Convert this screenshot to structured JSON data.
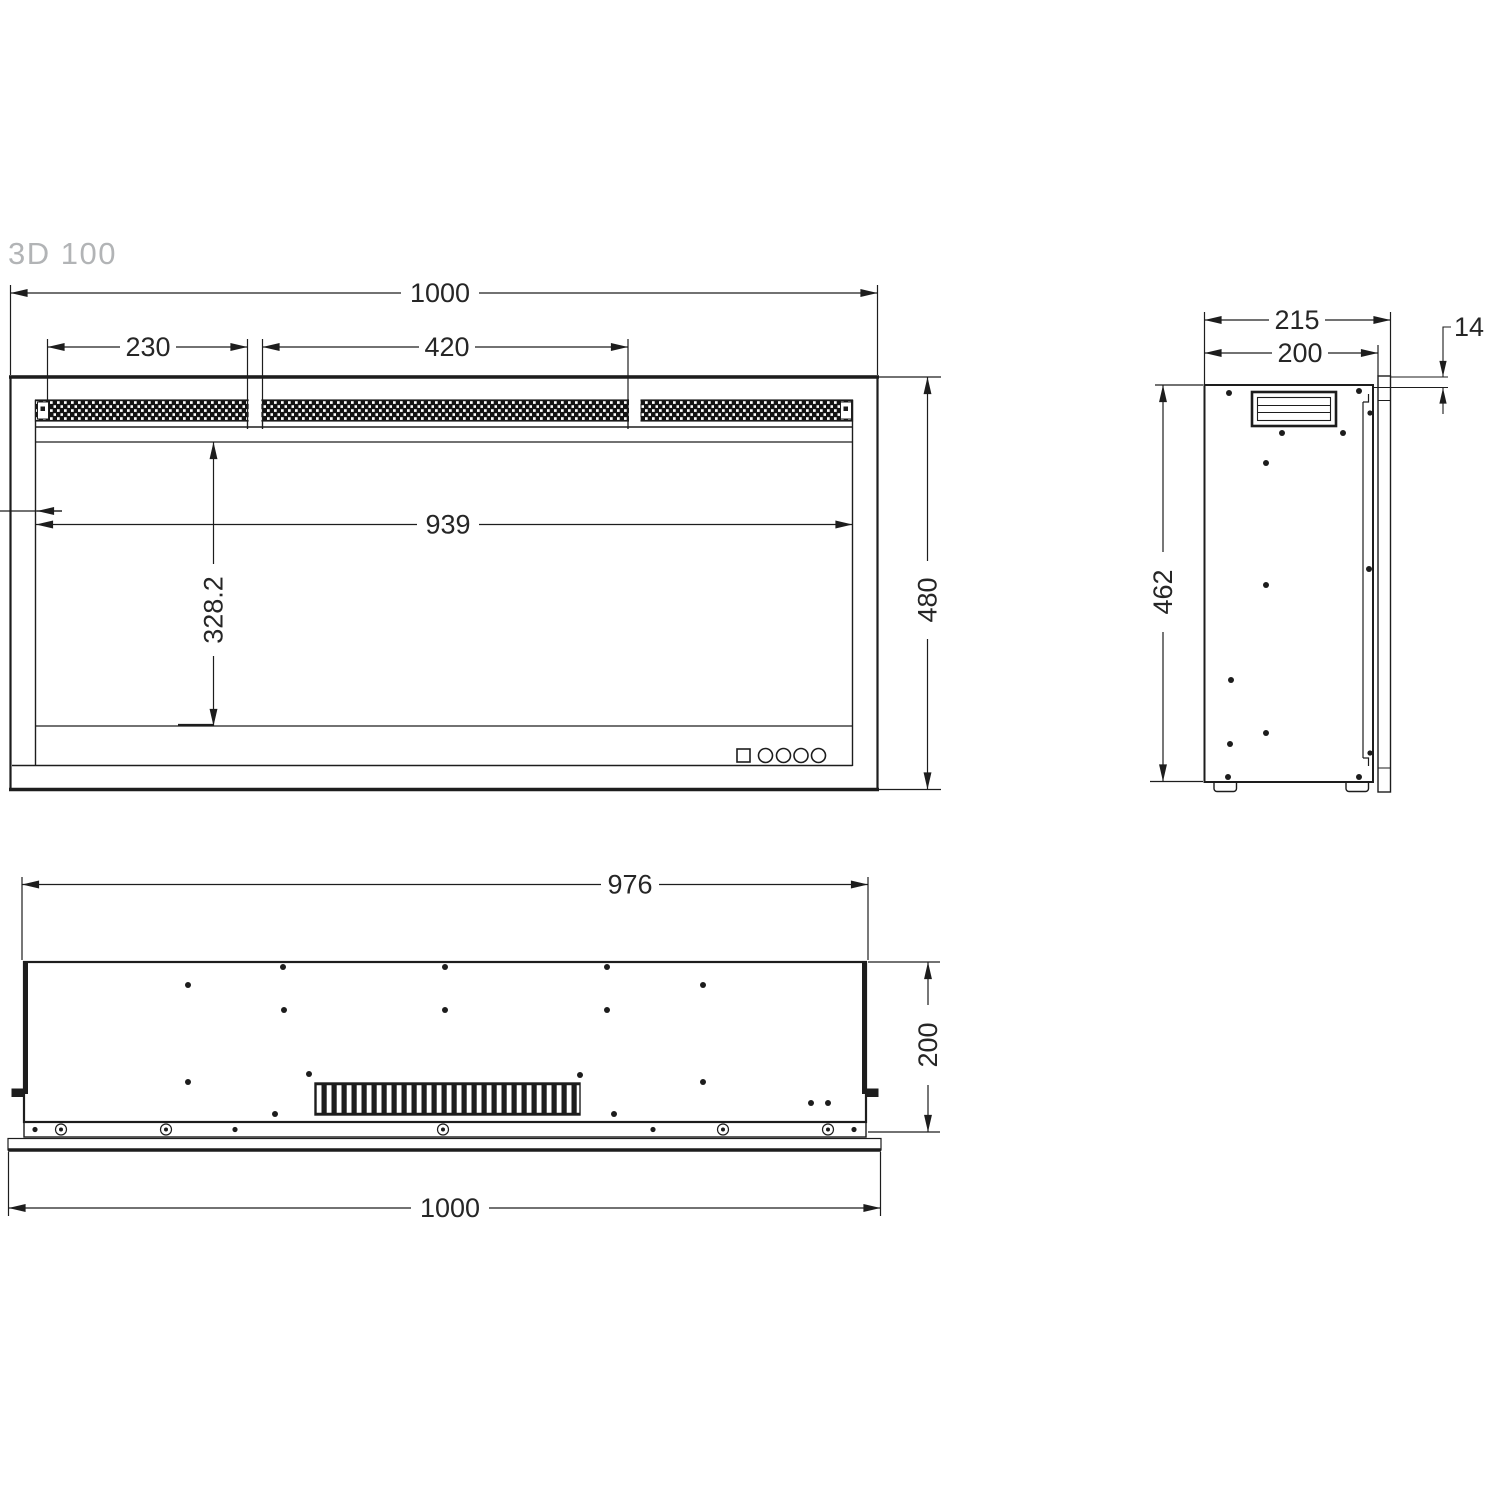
{
  "title": "3D 100",
  "drawing": {
    "type": "technical-dimension-drawing",
    "line_color": "#1d1d1d",
    "text_color": "#262626",
    "title_color": "#b2b4b6",
    "background": "#ffffff"
  },
  "front_view": {
    "name": "front view",
    "dims": {
      "overall_width": "1000",
      "top_vent_left_section": "230",
      "top_vent_center_section": "420",
      "inner_width": "939",
      "glass_opening_height": "328.2",
      "overall_height": "480"
    }
  },
  "side_view": {
    "name": "side view",
    "dims": {
      "overall_depth": "215",
      "body_depth": "200",
      "front_frame_depth": "14",
      "body_height": "462"
    }
  },
  "bottom_view": {
    "name": "bottom view",
    "dims": {
      "body_width": "976",
      "body_depth": "200",
      "overall_width": "1000"
    }
  }
}
